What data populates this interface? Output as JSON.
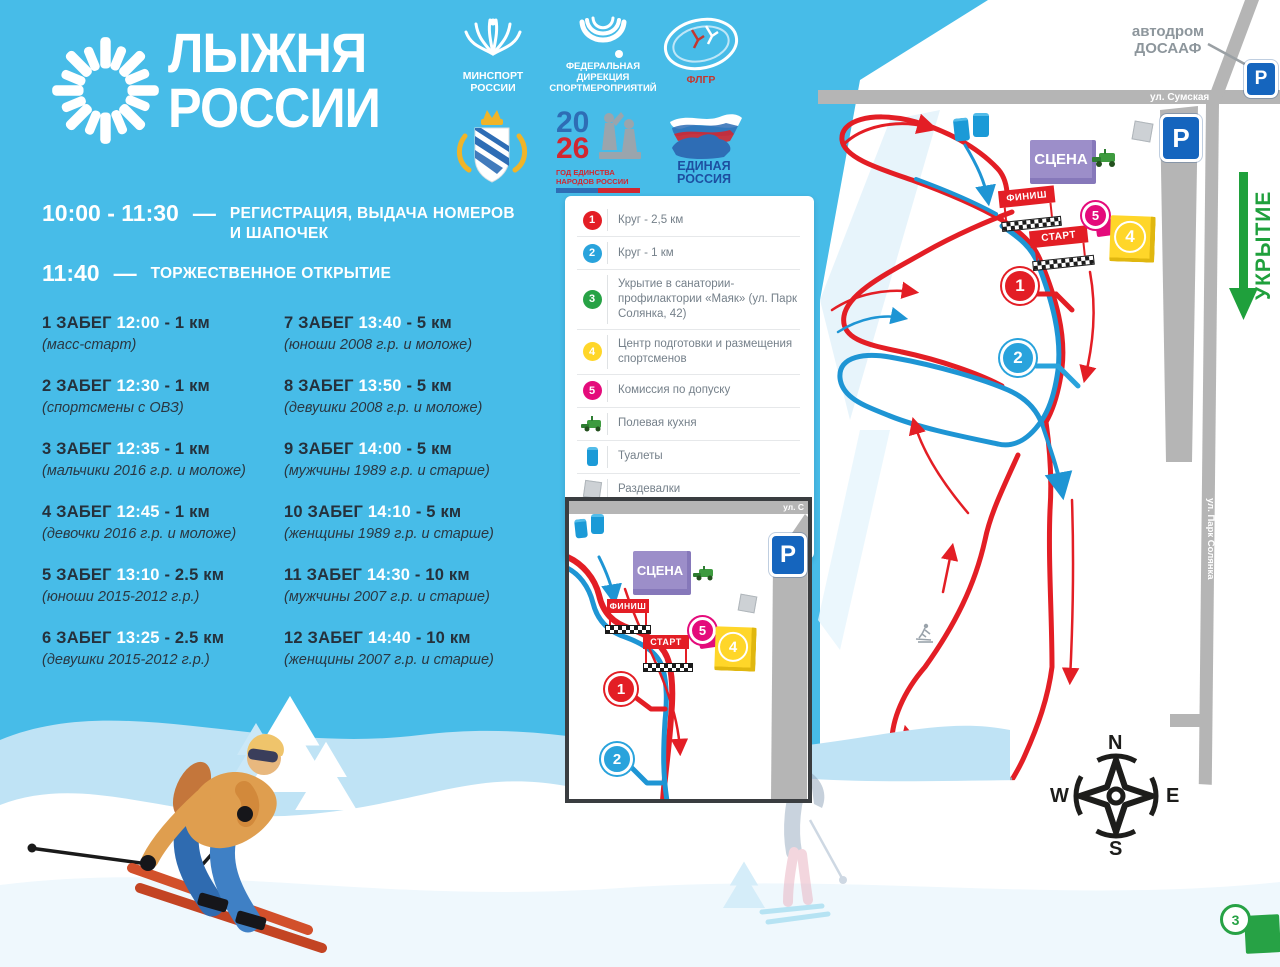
{
  "title": {
    "line1": "ЛЫЖНЯ",
    "line2": "РОССИИ"
  },
  "partners": {
    "minsport": {
      "lines": [
        "МИНСПОРТ",
        "РОССИИ"
      ]
    },
    "fds": {
      "lines": [
        "ФЕДЕРАЛЬНАЯ",
        "ДИРЕКЦИЯ",
        "СПОРТМЕРОПРИЯТИЙ"
      ]
    },
    "flgr": {
      "label": "ФЛГР"
    },
    "year2026": {
      "top": "20",
      "bottom": "26",
      "cap1": "ГОД ЕДИНСТВА",
      "cap2": "НАРОДОВ РОССИИ"
    },
    "er": {
      "lines": [
        "ЕДИНАЯ",
        "РОССИЯ"
      ]
    }
  },
  "ui": {
    "dash": "—"
  },
  "schedule": [
    {
      "time": "10:00 - 11:30",
      "lines": [
        "РЕГИСТРАЦИЯ, ВЫДАЧА НОМЕРОВ",
        "И ШАПОЧЕК"
      ]
    },
    {
      "time": "11:40",
      "lines": [
        "ТОРЖЕСТВЕННОЕ ОТКРЫТИЕ"
      ]
    }
  ],
  "races": [
    {
      "name": "1 ЗАБЕГ",
      "time": "12:00",
      "dist": "- 1 км",
      "desc": "(масс-старт)"
    },
    {
      "name": "2 ЗАБЕГ",
      "time": "12:30",
      "dist": "- 1 км",
      "desc": "(спортсмены с ОВЗ)"
    },
    {
      "name": "3 ЗАБЕГ",
      "time": "12:35",
      "dist": "- 1 км",
      "desc": "(мальчики 2016 г.р. и моложе)"
    },
    {
      "name": "4 ЗАБЕГ",
      "time": "12:45",
      "dist": "- 1 км",
      "desc": "(девочки 2016 г.р. и моложе)"
    },
    {
      "name": "5 ЗАБЕГ",
      "time": "13:10",
      "dist": "- 2.5 км",
      "desc": "(юноши 2015-2012 г.р.)"
    },
    {
      "name": "6 ЗАБЕГ",
      "time": "13:25",
      "dist": "- 2.5 км",
      "desc": "(девушки 2015-2012 г.р.)"
    },
    {
      "name": "7 ЗАБЕГ",
      "time": "13:40",
      "dist": "- 5 км",
      "desc": "(юноши 2008 г.р. и моложе)"
    },
    {
      "name": "8 ЗАБЕГ",
      "time": "13:50",
      "dist": "- 5 км",
      "desc": "(девушки 2008 г.р. и моложе)"
    },
    {
      "name": "9 ЗАБЕГ",
      "time": "14:00",
      "dist": "- 5 км",
      "desc": "(мужчины 1989 г.р. и старше)"
    },
    {
      "name": "10 ЗАБЕГ",
      "time": "14:10",
      "dist": "- 5 км",
      "desc": "(женщины 1989 г.р. и старше)"
    },
    {
      "name": "11 ЗАБЕГ",
      "time": "14:30",
      "dist": "- 10 км",
      "desc": "(мужчины 2007 г.р. и старше)"
    },
    {
      "name": "12 ЗАБЕГ",
      "time": "14:40",
      "dist": "- 10 км",
      "desc": "(женщины 2007 г.р. и старше)"
    }
  ],
  "legend": [
    {
      "badge": "1",
      "text": "Круг - 2,5 км"
    },
    {
      "badge": "2",
      "text": "Круг - 1 км"
    },
    {
      "badge": "3",
      "text": "Укрытие в санатории-профилактории «Маяк» (ул. Парк Солянка, 42)"
    },
    {
      "badge": "4",
      "text": "Центр подготовки и размещения спортсменов"
    },
    {
      "badge": "5",
      "text": "Комиссия по допуску"
    },
    {
      "icon": "field-kitchen",
      "text": "Полевая кухня"
    },
    {
      "icon": "toilet",
      "text": "Туалеты"
    },
    {
      "icon": "locker",
      "text": "Раздевалки"
    },
    {
      "icon": "clockwise",
      "text": "Движение осуществляется по часовой стрелке"
    }
  ],
  "map": {
    "scene": "СЦЕНА",
    "finish": "ФИНИШ",
    "start": "СТАРТ",
    "parking": "P",
    "street_sumskaya": "ул. Сумская",
    "street_solyanka": "ул. Парк Солянка",
    "street_short": "ул. С",
    "autodrom1": "автодром",
    "autodrom2": "ДОСААФ",
    "ukrytie": "УКРЫТИЕ",
    "compass": {
      "n": "N",
      "w": "W",
      "e": "E",
      "s": "S"
    },
    "markers": {
      "m1": "1",
      "m2": "2",
      "m3": "3",
      "m4": "4",
      "m5": "5"
    }
  },
  "colors": {
    "background": "#47BCE8",
    "track_red": "#E31E25",
    "track_blue": "#1E95D4",
    "road_gray": "#B5B5B5",
    "scene_purple": "#9C8EC9",
    "center_yellow": "#FFD629",
    "commission_magenta": "#E40B7B",
    "shelter_green": "#27A245",
    "parking_blue": "#1565BE",
    "text_dark": "#25313C"
  }
}
